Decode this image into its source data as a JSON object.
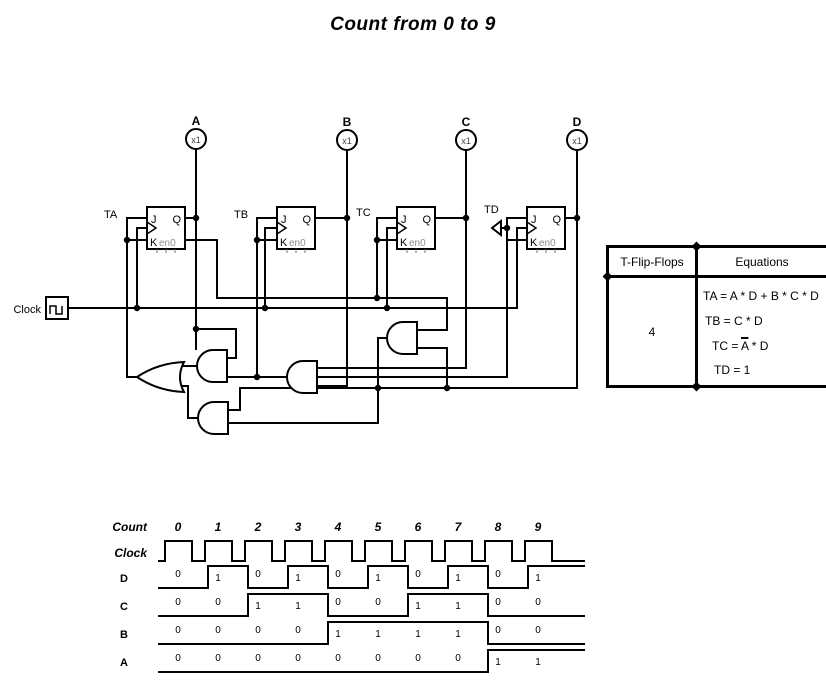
{
  "title": "Count from 0 to 9",
  "circuit": {
    "clock_label": "Clock",
    "pins": {
      "j": "J",
      "q": "Q",
      "k": "K",
      "en": "en0"
    },
    "flipflops": [
      {
        "label": "TA"
      },
      {
        "label": "TB"
      },
      {
        "label": "TC"
      },
      {
        "label": "TD"
      }
    ],
    "outputs": [
      {
        "letter": "A",
        "part": "x1"
      },
      {
        "letter": "B",
        "part": "x1"
      },
      {
        "letter": "C",
        "part": "x1"
      },
      {
        "letter": "D",
        "part": "x1"
      }
    ]
  },
  "table": {
    "col1_header": "T-Flip-Flops",
    "col2_header": "Equations",
    "flipflop_count": "4",
    "equations": [
      {
        "text": "TA = A * D + B * C * D"
      },
      {
        "text": "TB = C * D"
      },
      {
        "pre": "TC = ",
        "bar": "A",
        "post": " * D"
      },
      {
        "text": "TD = 1"
      }
    ]
  },
  "timing": {
    "count_label": "Count",
    "clock_label": "Clock",
    "counts": [
      "0",
      "1",
      "2",
      "3",
      "4",
      "5",
      "6",
      "7",
      "8",
      "9"
    ],
    "signals": [
      {
        "label": "D",
        "values": [
          0,
          1,
          0,
          1,
          0,
          1,
          0,
          1,
          0,
          1
        ]
      },
      {
        "label": "C",
        "values": [
          0,
          0,
          1,
          1,
          0,
          0,
          1,
          1,
          0,
          0
        ]
      },
      {
        "label": "B",
        "values": [
          0,
          0,
          0,
          0,
          1,
          1,
          1,
          1,
          0,
          0
        ]
      },
      {
        "label": "A",
        "values": [
          0,
          0,
          0,
          0,
          0,
          0,
          0,
          0,
          1,
          1
        ]
      }
    ]
  },
  "colors": {
    "ink": "#000000",
    "muted": "#8d8d8d",
    "background": "#ffffff"
  }
}
